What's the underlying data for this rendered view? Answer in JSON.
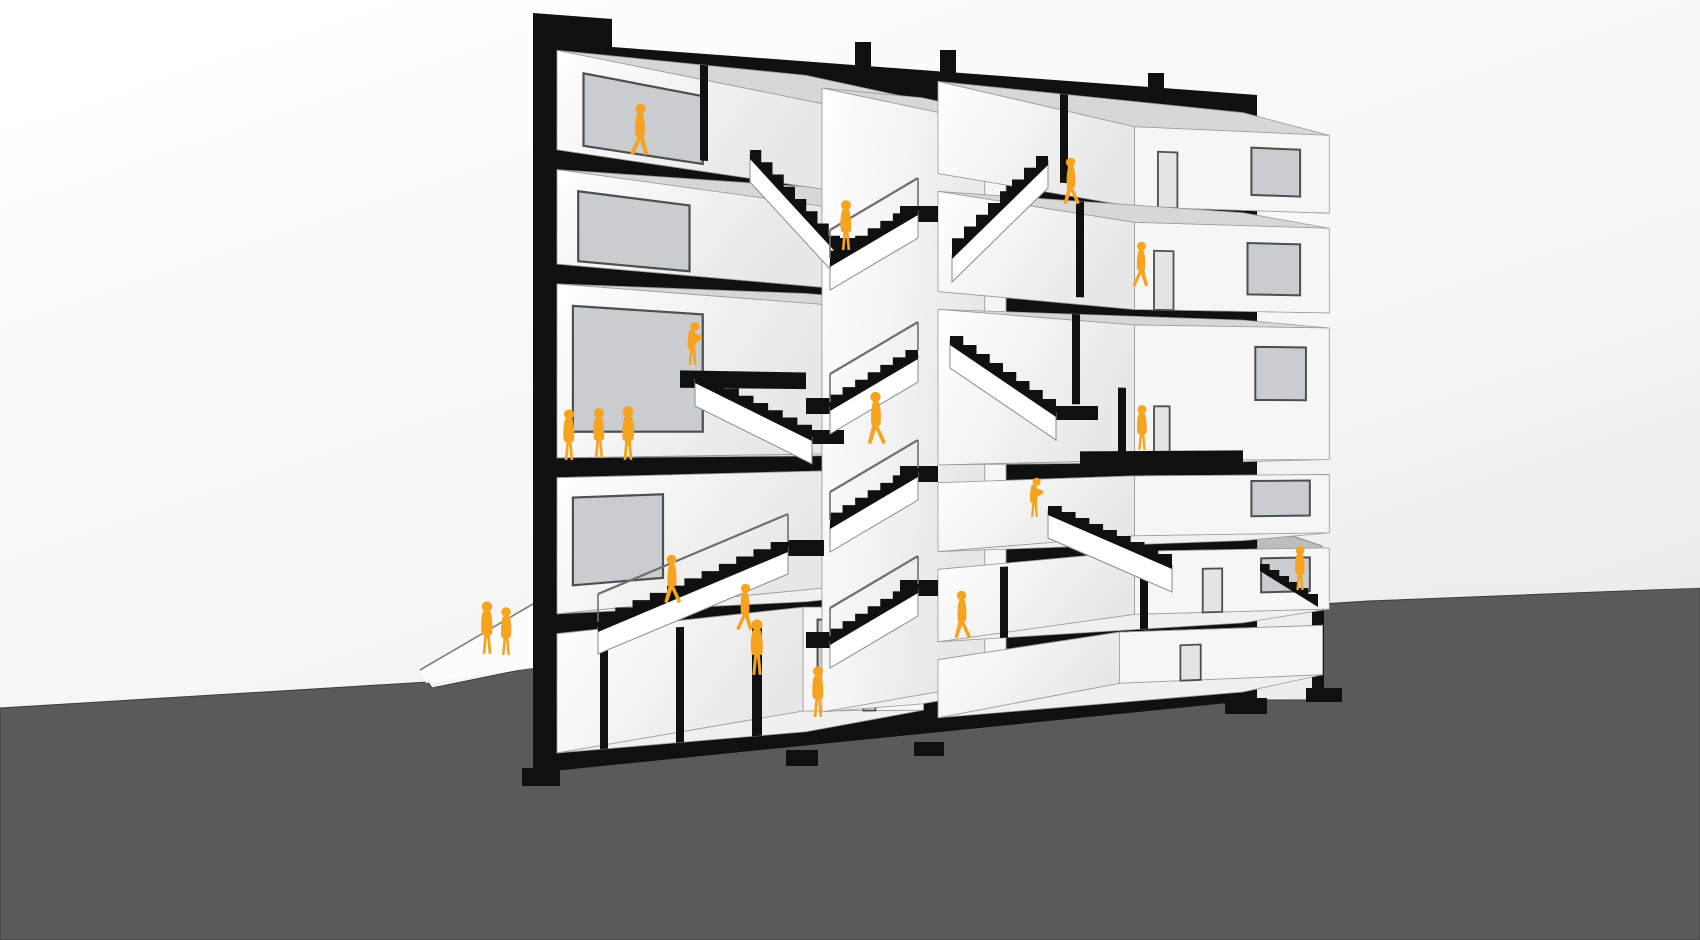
{
  "scene": {
    "width": 1700,
    "height": 940,
    "horizon_y": 430,
    "x_left": 533,
    "x_right": 1257,
    "perspective_shrink": 0.19,
    "vanish_x": 2450
  },
  "palette": {
    "sky_top": "#ffffff",
    "sky_mid": "#f7f7f7",
    "sky_low": "#e9e9e9",
    "ground": "#5a5a5a",
    "ground_dark": "#525252",
    "poche": "#101010",
    "room_face": "#fbfbfb",
    "ceiling": "#d7d7d7",
    "floor": "#f0f0f0",
    "side_wall": "#ebebeb",
    "back_wall": "#f6f6f6",
    "edge_line": "#9a9a9a",
    "frame": "#4e4e4e",
    "glass": "#c9cdd0",
    "door": "#e4e4e4",
    "stringer": "#ffffff",
    "rail": "#6f6f6f",
    "fence": "#b5b5b5",
    "sidewalk": "#fcfcfc",
    "paving": "#ededed",
    "figure": "#F6A41F"
  },
  "ground": {
    "surface": [
      [
        0,
        708
      ],
      [
        428,
        682
      ],
      [
        432,
        688
      ],
      [
        540,
        666
      ],
      [
        540,
        700
      ],
      [
        1322,
        700
      ],
      [
        1322,
        604
      ],
      [
        1368,
        601
      ],
      [
        1700,
        588
      ],
      [
        1700,
        940
      ],
      [
        0,
        940
      ]
    ],
    "paving_right": [
      [
        1322,
        600
      ],
      [
        1380,
        590
      ],
      [
        1700,
        574
      ],
      [
        1700,
        588
      ]
    ]
  },
  "sidewalk": {
    "wedge": [
      [
        420,
        670
      ],
      [
        533,
        604
      ],
      [
        533,
        668
      ],
      [
        426,
        683
      ]
    ],
    "curb_line": [
      [
        420,
        670
      ],
      [
        533,
        604
      ]
    ]
  },
  "fence_right": {
    "panel": [
      [
        1257,
        524
      ],
      [
        1322,
        546
      ],
      [
        1322,
        602
      ],
      [
        1257,
        568
      ]
    ]
  },
  "retaining_wall": {
    "rect": [
      1312,
      598,
      12,
      94
    ]
  },
  "building": {
    "silhouette": [
      [
        533,
        13
      ],
      [
        612,
        19
      ],
      [
        612,
        47
      ],
      [
        1257,
        95
      ],
      [
        1257,
        700
      ],
      [
        533,
        773
      ]
    ],
    "roof_stubs": [
      [
        855,
        42,
        16,
        28
      ],
      [
        940,
        50,
        16,
        26
      ],
      [
        1148,
        73,
        16,
        18
      ]
    ],
    "footings": [
      [
        522,
        768,
        38,
        18
      ],
      [
        786,
        750,
        32,
        16
      ],
      [
        914,
        742,
        30,
        14
      ],
      [
        1136,
        692,
        38,
        16
      ],
      [
        1225,
        698,
        42,
        16
      ],
      [
        1306,
        688,
        36,
        14
      ]
    ]
  },
  "rooms": [
    {
      "name": "left-bay-top",
      "x0": 557,
      "x1": 806,
      "yt": 48,
      "yb": 148,
      "t": 0.14,
      "win": [
        0.1,
        0.55,
        0.18,
        0.92
      ],
      "door": [
        0.62,
        0.74,
        0.3,
        1
      ],
      "bwin": null
    },
    {
      "name": "left-bay-4",
      "x0": 557,
      "x1": 806,
      "yt": 168,
      "yb": 263,
      "t": 0.14,
      "win": [
        0.08,
        0.5,
        0.2,
        0.95
      ],
      "door": [
        0.6,
        0.72,
        0.32,
        1
      ],
      "bwin": null
    },
    {
      "name": "left-bay-3-tall",
      "x0": 557,
      "x1": 806,
      "yt": 283,
      "yb": 458,
      "t": 0.14,
      "win": [
        0.06,
        0.55,
        0.12,
        0.85
      ],
      "door": [
        0.66,
        0.76,
        0.55,
        1
      ],
      "bwin": null
    },
    {
      "name": "left-bay-2",
      "x0": 557,
      "x1": 806,
      "yt": 478,
      "yb": 615,
      "t": 0.14,
      "win": [
        0.06,
        0.4,
        0.15,
        0.8
      ],
      "door": null,
      "bwin": [
        0.55,
        0.75,
        0.15,
        0.75
      ]
    },
    {
      "name": "left-bay-basement",
      "x0": 557,
      "x1": 806,
      "yt": 635,
      "yb": 755,
      "t": 0.13,
      "win": null,
      "door": [
        0.5,
        0.6,
        0.3,
        1
      ],
      "bwin": [
        0.12,
        0.42,
        0.12,
        0.72
      ]
    },
    {
      "name": "stair-core-shaft",
      "x0": 822,
      "x1": 922,
      "yt": 60,
      "yb": 735,
      "t": 0.1,
      "win": null,
      "door": null,
      "bwin": null
    },
    {
      "name": "right-bay-top",
      "x0": 938,
      "x1": 1243,
      "yt": 40,
      "yb": 143,
      "t": 0.13,
      "win": null,
      "door": [
        0.12,
        0.22,
        0.3,
        1
      ],
      "bwin": [
        0.6,
        0.85,
        0.2,
        0.8
      ]
    },
    {
      "name": "right-bay-4",
      "x0": 938,
      "x1": 1243,
      "yt": 163,
      "yb": 275,
      "t": 0.13,
      "win": null,
      "door": [
        0.1,
        0.2,
        0.32,
        1
      ],
      "bwin": [
        0.58,
        0.85,
        0.2,
        0.8
      ]
    },
    {
      "name": "right-bay-3-tall",
      "x0": 938,
      "x1": 1243,
      "yt": 295,
      "yb": 469,
      "t": 0.13,
      "win": null,
      "door": [
        0.1,
        0.18,
        0.6,
        1
      ],
      "bwin": [
        0.62,
        0.88,
        0.15,
        0.55
      ]
    },
    {
      "name": "right-bay-2",
      "x0": 938,
      "x1": 1243,
      "yt": 489,
      "yb": 566,
      "t": 0.13,
      "win": null,
      "door": null,
      "bwin": [
        0.6,
        0.9,
        0.1,
        0.7
      ]
    },
    {
      "name": "right-bay-1",
      "x0": 938,
      "x1": 1243,
      "yt": 586,
      "yb": 667,
      "t": 0.13,
      "win": null,
      "door": [
        0.35,
        0.45,
        0.3,
        1
      ],
      "bwin": [
        0.65,
        0.9,
        0.15,
        0.7
      ]
    },
    {
      "name": "right-bay-basement",
      "x0": 938,
      "x1": 1243,
      "yt": 687,
      "yb": 752,
      "t": 0.12,
      "win": null,
      "door": [
        0.3,
        0.4,
        0.3,
        1
      ],
      "bwin": null
    }
  ],
  "persp_overlays": [
    {
      "name": "partition-top-left",
      "q": [
        700,
        708,
        48,
        148
      ]
    },
    {
      "name": "mezzanine-slab",
      "q": [
        680,
        806,
        368,
        386
      ]
    },
    {
      "name": "basement-partition-1",
      "q": [
        600,
        608,
        635,
        755
      ]
    },
    {
      "name": "basement-partition-2",
      "q": [
        676,
        684,
        635,
        755
      ]
    },
    {
      "name": "basement-partition-3",
      "q": [
        752,
        762,
        635,
        755
      ]
    },
    {
      "name": "right-top-partition",
      "q": [
        1060,
        1068,
        40,
        143
      ]
    },
    {
      "name": "right-4-partition",
      "q": [
        1076,
        1084,
        163,
        275
      ]
    },
    {
      "name": "right-3-partition",
      "q": [
        1072,
        1080,
        295,
        400
      ]
    },
    {
      "name": "right-3-subslab",
      "q": [
        1080,
        1243,
        455,
        472
      ]
    },
    {
      "name": "right-3-partition-b",
      "q": [
        1118,
        1126,
        380,
        469
      ]
    },
    {
      "name": "right-1-partition-a",
      "q": [
        1000,
        1008,
        586,
        667
      ]
    },
    {
      "name": "right-1-partition-b",
      "q": [
        1140,
        1148,
        586,
        667
      ]
    }
  ],
  "screen_overlays": [
    {
      "name": "core-landing-a",
      "r": [
        820,
        238,
        66,
        18
      ]
    },
    {
      "name": "core-landing-b",
      "r": [
        900,
        206,
        38,
        16
      ]
    },
    {
      "name": "core-landing-c",
      "r": [
        806,
        398,
        40,
        16
      ]
    },
    {
      "name": "core-landing-d",
      "r": [
        900,
        466,
        38,
        16
      ]
    },
    {
      "name": "core-landing-e",
      "r": [
        806,
        632,
        40,
        16
      ]
    },
    {
      "name": "core-landing-f",
      "r": [
        900,
        580,
        38,
        16
      ]
    },
    {
      "name": "mezz-stair-landing",
      "r": [
        812,
        430,
        32,
        14
      ]
    },
    {
      "name": "right-mid-landing",
      "r": [
        1056,
        406,
        42,
        14
      ]
    },
    {
      "name": "ground-stair-landing",
      "r": [
        788,
        540,
        36,
        16
      ]
    }
  ],
  "stairs": [
    {
      "name": "stair-top-left",
      "hx": 750,
      "hy": 150,
      "lx": 840,
      "ly": 248,
      "n": 8,
      "th": 9,
      "stringer": true,
      "rail": false
    },
    {
      "name": "stair-top-right",
      "hx": 1048,
      "hy": 156,
      "lx": 952,
      "ly": 250,
      "n": 8,
      "th": 9,
      "stringer": true,
      "rail": false
    },
    {
      "name": "stair-mezzanine",
      "hx": 695,
      "hy": 374,
      "lx": 812,
      "ly": 432,
      "n": 8,
      "th": 9,
      "stringer": true,
      "rail": false
    },
    {
      "name": "stair-ground-left",
      "hx": 788,
      "hy": 542,
      "lx": 598,
      "ly": 622,
      "n": 11,
      "th": 10,
      "stringer": true,
      "rail": true
    },
    {
      "name": "stair-right-mid",
      "hx": 1048,
      "hy": 506,
      "lx": 1172,
      "ly": 560,
      "n": 9,
      "th": 9,
      "stringer": true,
      "rail": false
    },
    {
      "name": "stair-right-upper",
      "hx": 950,
      "hy": 336,
      "lx": 1056,
      "ly": 408,
      "n": 8,
      "th": 9,
      "stringer": true,
      "rail": false
    },
    {
      "name": "stair-exterior",
      "hx": 1260,
      "hy": 564,
      "lx": 1318,
      "ly": 600,
      "n": 6,
      "th": 7,
      "stringer": false,
      "rail": false
    },
    {
      "name": "core-flight-1",
      "hx": 918,
      "hy": 206,
      "lx": 830,
      "ly": 258,
      "n": 7,
      "th": 9,
      "stringer": true,
      "rail": true
    },
    {
      "name": "core-flight-2",
      "hx": 918,
      "hy": 350,
      "lx": 830,
      "ly": 402,
      "n": 7,
      "th": 9,
      "stringer": true,
      "rail": true
    },
    {
      "name": "core-flight-3",
      "hx": 918,
      "hy": 468,
      "lx": 830,
      "ly": 520,
      "n": 7,
      "th": 9,
      "stringer": true,
      "rail": true
    },
    {
      "name": "core-flight-4",
      "hx": 918,
      "hy": 584,
      "lx": 830,
      "ly": 636,
      "n": 7,
      "th": 9,
      "stringer": true,
      "rail": true
    }
  ],
  "figures": [
    {
      "name": "figure-walking-top-left",
      "x": 640,
      "y": 157,
      "h": 54,
      "pose": "walk",
      "flip": false
    },
    {
      "name": "figure-core-landing-top",
      "x": 846,
      "y": 251,
      "h": 52,
      "pose": "stand",
      "flip": false
    },
    {
      "name": "figure-stair-top-right",
      "x": 1071,
      "y": 206,
      "h": 49,
      "pose": "walk",
      "flip": true
    },
    {
      "name": "figure-walking-right-4",
      "x": 1141,
      "y": 288,
      "h": 47,
      "pose": "walk",
      "flip": false
    },
    {
      "name": "figure-mezzanine-climber",
      "x": 692,
      "y": 366,
      "h": 47,
      "pose": "lean",
      "flip": false
    },
    {
      "name": "figure-core-stair-mid",
      "x": 876,
      "y": 446,
      "h": 55,
      "pose": "walk",
      "flip": true
    },
    {
      "name": "figure-group-left-1",
      "x": 569,
      "y": 461,
      "h": 53,
      "pose": "stand",
      "flip": false
    },
    {
      "name": "figure-group-left-2",
      "x": 599,
      "y": 459,
      "h": 52,
      "pose": "stand",
      "flip": false
    },
    {
      "name": "figure-group-left-3",
      "x": 628,
      "y": 461,
      "h": 56,
      "pose": "stand",
      "flip": true
    },
    {
      "name": "figure-right-3-standing",
      "x": 1142,
      "y": 451,
      "h": 47,
      "pose": "stand",
      "flip": false
    },
    {
      "name": "figure-right-rail-leaning",
      "x": 1034,
      "y": 518,
      "h": 43,
      "pose": "lean",
      "flip": false
    },
    {
      "name": "figure-core-stair-lower",
      "x": 962,
      "y": 640,
      "h": 50,
      "pose": "walk",
      "flip": true
    },
    {
      "name": "figure-ground-stair-walker",
      "x": 672,
      "y": 605,
      "h": 51,
      "pose": "walk",
      "flip": true
    },
    {
      "name": "figure-ground-floor-walker",
      "x": 745,
      "y": 632,
      "h": 49,
      "pose": "walk",
      "flip": false
    },
    {
      "name": "figure-basement-core",
      "x": 818,
      "y": 718,
      "h": 53,
      "pose": "stand",
      "flip": false
    },
    {
      "name": "figure-sidewalk-pair-1",
      "x": 487,
      "y": 655,
      "h": 55,
      "pose": "stand",
      "flip": false
    },
    {
      "name": "figure-sidewalk-pair-2",
      "x": 506,
      "y": 656,
      "h": 50,
      "pose": "stand",
      "flip": true
    },
    {
      "name": "figure-entry-hall",
      "x": 757,
      "y": 676,
      "h": 58,
      "pose": "stand",
      "flip": false
    },
    {
      "name": "figure-exterior-stair-right",
      "x": 1300,
      "y": 591,
      "h": 46,
      "pose": "stand",
      "flip": false
    }
  ],
  "figure_paths": {
    "stand_body": "M-8,-78 C-12,-60 -11,-44 -9,-37 L-5,-36 L-8,-2 L-3,-2 L0,-33 L3,-2 L8,-2 L5,-36 L9,-37 C11,-48 10,-64 7,-78 C2,-82 -3,-82 -8,-78 Z",
    "walk_body": "M-6,-79 C-10,-62 -9,-46 -8,-38 L-4,-37 L-18,-7 L-12,-3 L0,-30 L9,-3 L15,-6 L7,-37 L8,-38 C10,-50 9,-66 6,-79 C1,-82 -2,-82 -6,-79 Z",
    "lean_body": "M-6,-76 C-10,-60 -10,-44 -8,-36 L-4,-35 L-7,-2 L-2,-2 L1,-32 L4,-2 L9,-2 L7,-35 L7,-48 L22,-58 L21,-64 L8,-68 C6,-74 0,-80 -6,-76 Z",
    "head": {
      "stand": [
        0,
        -88,
        9.5
      ],
      "walk": [
        1,
        -89,
        9.5
      ],
      "lean": [
        6,
        -84,
        9.5
      ]
    }
  }
}
